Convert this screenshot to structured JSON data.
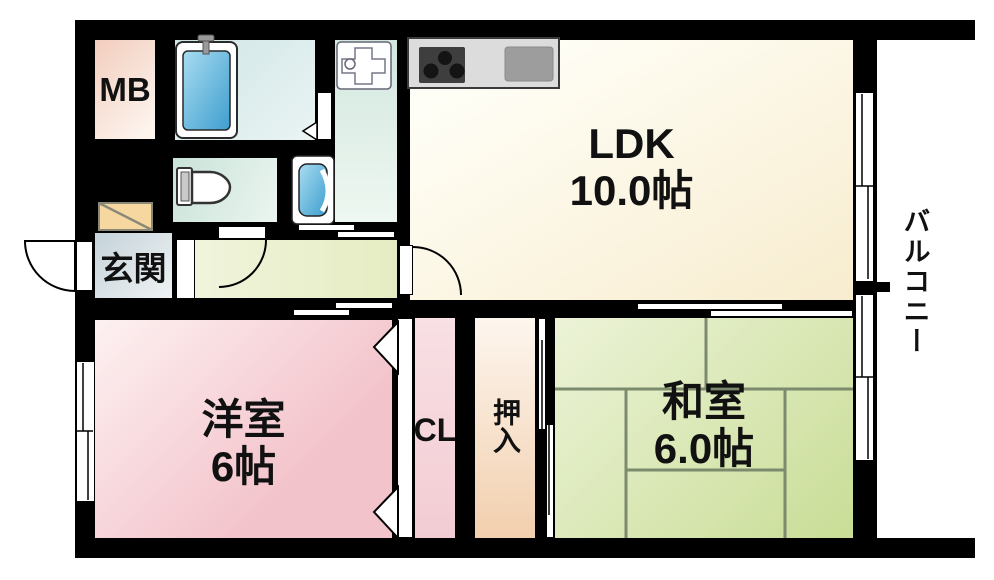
{
  "plan": {
    "rooms": {
      "mb": {
        "label": "MB"
      },
      "genkan": {
        "label": "玄関"
      },
      "ldk": {
        "name": "LDK",
        "area": "10.0帖"
      },
      "yoshitsu": {
        "name": "洋室",
        "area": "6帖"
      },
      "washitsu": {
        "name": "和室",
        "area": "6.0帖"
      },
      "cl": {
        "label": "CL"
      },
      "oshiire": {
        "label": "押入"
      },
      "balcony": {
        "label": "バルコニー"
      }
    },
    "colors": {
      "wall": "#000000",
      "ldk-floor": "#f7ecce",
      "hallway-floor": "#e6ecc2",
      "genkan-floor": "#c5d3da",
      "mb-floor": "#f2cdbd",
      "bathroom-floor": "#cfe5e6",
      "toilet-floor": "#c9e3d8",
      "washroom-floor": "#d2e8df",
      "yoshitsu-floor": "#f3c3cb",
      "cl-floor": "#f2ccd3",
      "oshiire-floor": "#f2cfae",
      "washitsu-floor": "#c9dd96",
      "tatami-line": "#7c8a6d",
      "tub-blue": "#3e9ecf",
      "counter-gray": "#dcdcdc",
      "stove-dark": "#3e3e3e",
      "sink-gray": "#9d9d9d",
      "shoe-box": "#f6d79f"
    }
  }
}
